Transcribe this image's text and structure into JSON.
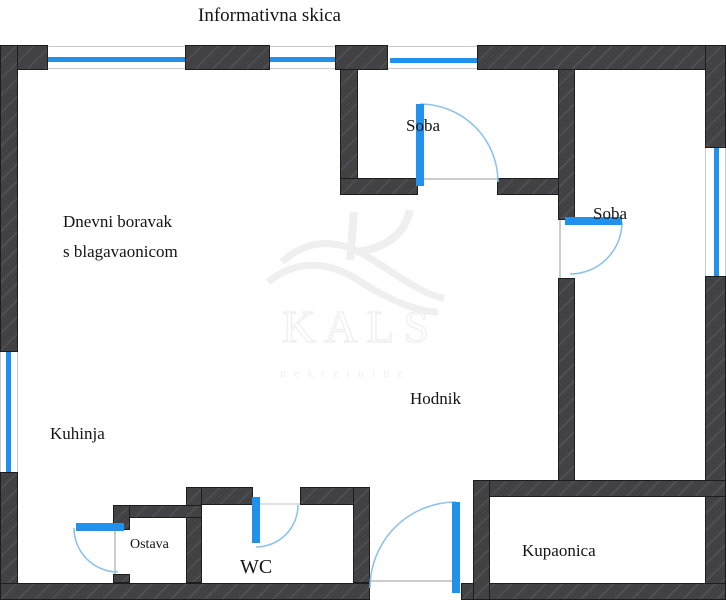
{
  "title": "Informativna skica",
  "watermark": {
    "brand": "KALS",
    "subtitle": "nekretnine",
    "logo_icon": "kals-k-wave-logo"
  },
  "rooms": {
    "living_room": {
      "line1": "Dnevni boravak",
      "line2": "s blagavaonicom"
    },
    "bedroom_top": {
      "label": "Soba"
    },
    "bedroom_right": {
      "label": "Soba"
    },
    "kitchen": {
      "label": "Kuhinja"
    },
    "hallway": {
      "label": "Hodnik"
    },
    "pantry": {
      "label": "Ostava"
    },
    "wc": {
      "label": "WC"
    },
    "bathroom": {
      "label": "Kupaonica"
    }
  },
  "colors": {
    "background": "#ffffff",
    "wall": "#424245",
    "wall_hatch": "#4f4f53",
    "wall_outline": "#1d1d1f",
    "opening_blue": "#2191ee",
    "door_arc_blue": "#8ec3ec",
    "watermark_gray": "#efefef",
    "text_black": "#141414"
  }
}
